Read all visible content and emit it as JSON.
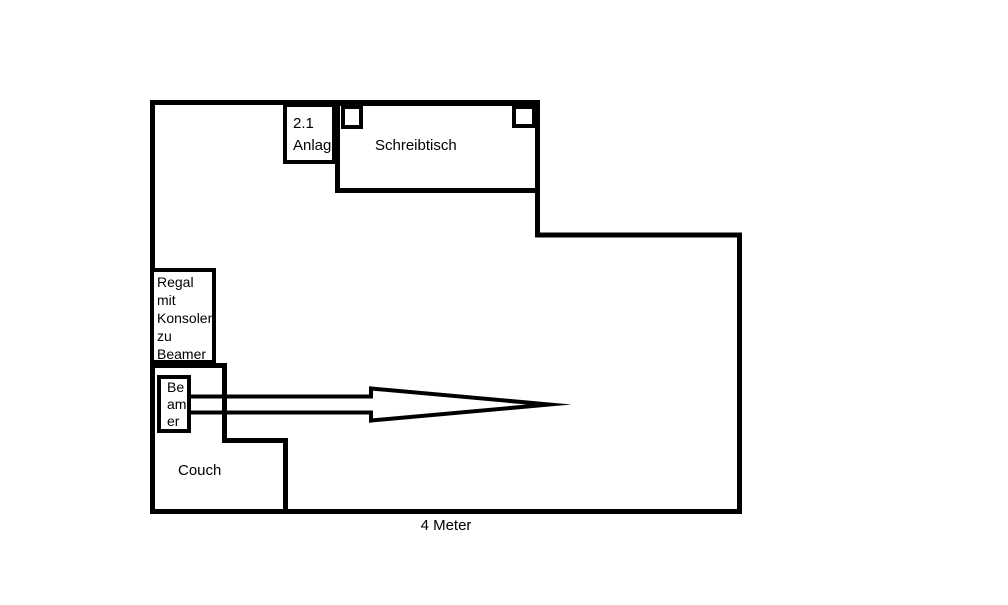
{
  "colors": {
    "ink": "#000000",
    "background": "#ffffff"
  },
  "floor_plan": {
    "desk": {
      "label": "Schreibtisch"
    },
    "audio_system": {
      "lines": [
        "2.1",
        "Anlage"
      ]
    },
    "shelf": {
      "lines": [
        "Regal",
        "mit",
        "Konsolen",
        "zu",
        "Beamer"
      ]
    },
    "beamer": {
      "lines": [
        "Be",
        "am",
        "er"
      ]
    },
    "couch": {
      "label": "Couch"
    },
    "dimension": {
      "label": "4 Meter"
    }
  }
}
